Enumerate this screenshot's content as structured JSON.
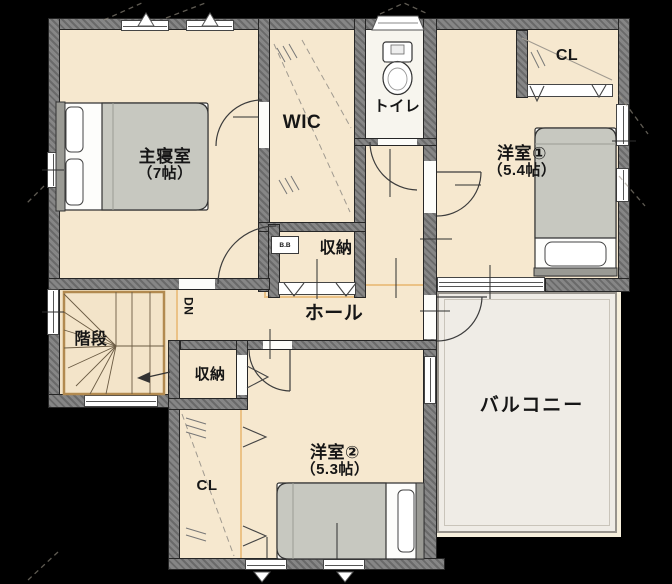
{
  "plan": {
    "type": "floor-plan",
    "rooms": [
      {
        "id": "master_bedroom",
        "label": "主寝室",
        "size_label": "（7帖）"
      },
      {
        "id": "wic",
        "label": "WIC"
      },
      {
        "id": "toilet",
        "label": "トイレ"
      },
      {
        "id": "bedroom1",
        "label": "洋室①",
        "size_label": "（5.4帖）"
      },
      {
        "id": "closet1",
        "label": "CL"
      },
      {
        "id": "storage_top",
        "label": "収納"
      },
      {
        "id": "hall",
        "label": "ホール"
      },
      {
        "id": "stairs",
        "label": "階段"
      },
      {
        "id": "stairs_direction",
        "label": "DN"
      },
      {
        "id": "storage_bottom",
        "label": "収納"
      },
      {
        "id": "closet2",
        "label": "CL"
      },
      {
        "id": "bedroom2",
        "label": "洋室②",
        "size_label": "（5.3帖）"
      },
      {
        "id": "balcony",
        "label": "バルコニー"
      },
      {
        "id": "cabinet",
        "label": "B.B"
      }
    ]
  },
  "colors": {
    "background": "#000000",
    "floor": "#f6e8cf",
    "wall": "#7e7e7e",
    "balcony": "#efece6",
    "accent": "#e2a24b",
    "bed": "#c7c8c0",
    "text": "#161616"
  }
}
